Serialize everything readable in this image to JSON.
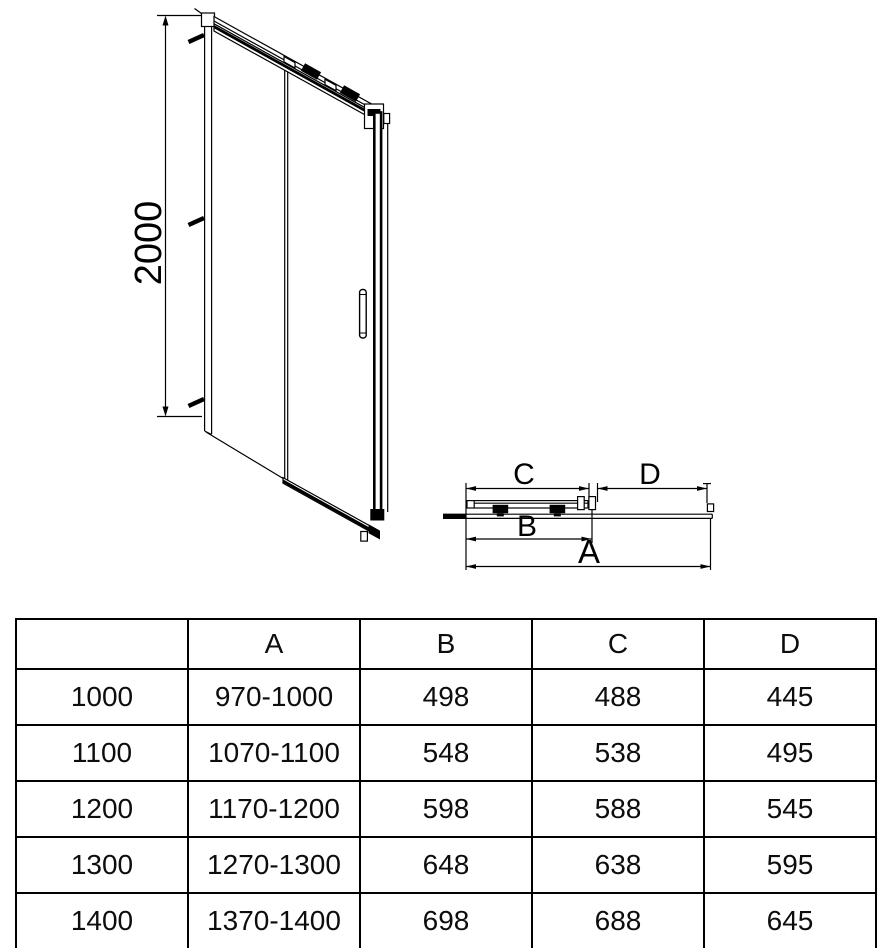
{
  "drawing": {
    "front_view": {
      "height_label": "2000"
    },
    "plan_view": {
      "label_a": "A",
      "label_b": "B",
      "label_c": "C",
      "label_d": "D"
    }
  },
  "table": {
    "headers": [
      "",
      "A",
      "B",
      "C",
      "D"
    ],
    "rows": [
      [
        "1000",
        "970-1000",
        "498",
        "488",
        "445"
      ],
      [
        "1100",
        "1070-1100",
        "548",
        "538",
        "495"
      ],
      [
        "1200",
        "1170-1200",
        "598",
        "588",
        "545"
      ],
      [
        "1300",
        "1270-1300",
        "648",
        "638",
        "595"
      ],
      [
        "1400",
        "1370-1400",
        "698",
        "688",
        "645"
      ]
    ]
  },
  "colors": {
    "line": "#000000",
    "background": "#ffffff"
  }
}
